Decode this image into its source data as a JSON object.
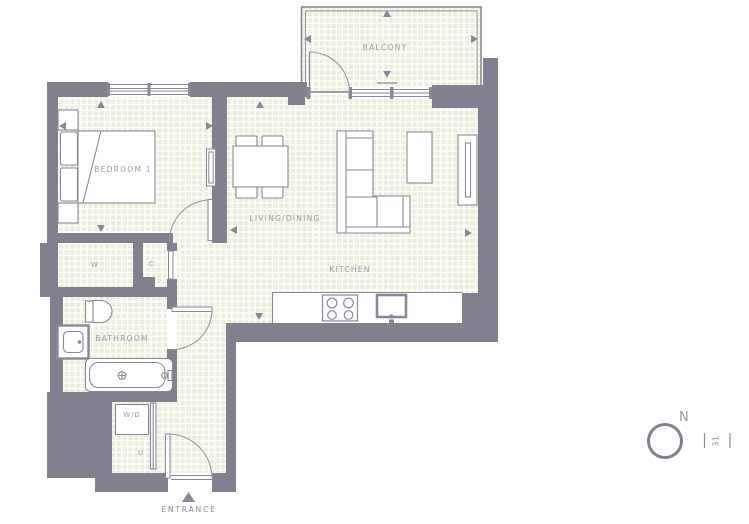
{
  "title": "Apartment floor plan",
  "colors": {
    "wall": "#837f8e",
    "floor_tile": "#ecedda",
    "grout": "#ffffff",
    "fixture_line": "#8b8798",
    "door_arc": "#9b97a6",
    "label_text": "#9c98a8"
  },
  "labels": {
    "bedroom": "BEDROOM 1",
    "living_dining": "LIVING/DINING",
    "kitchen": "KITCHEN",
    "balcony": "BALCONY",
    "bathroom": "BATHROOM",
    "wardrobe": "W",
    "closet": "C",
    "washer_dryer": "W/D",
    "utility": "U",
    "entrance": "ENTRANCE"
  },
  "compass": {
    "north": "N",
    "plot_number": "31"
  }
}
